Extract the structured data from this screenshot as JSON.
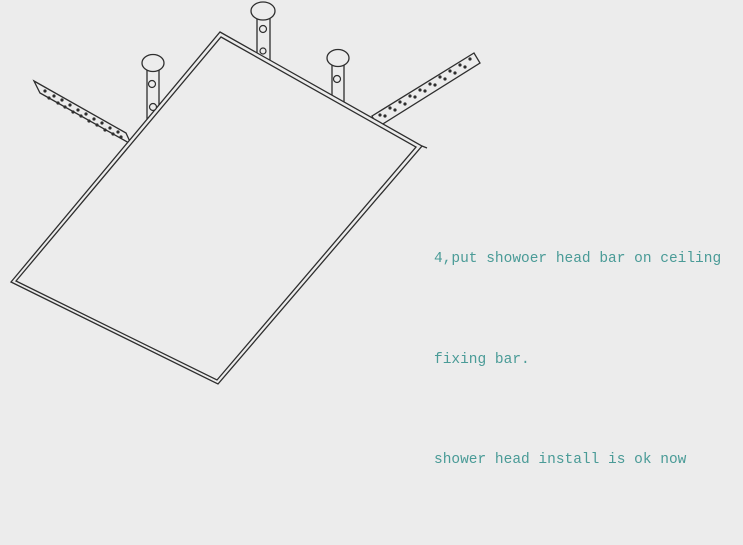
{
  "colors": {
    "background": "#ececec",
    "line": "#2e2e2e",
    "text": "#4a9b97"
  },
  "instructions": {
    "lines": [
      "4,put showoer head bar on ceiling",
      "fixing bar.",
      "shower head install is ok now"
    ]
  }
}
